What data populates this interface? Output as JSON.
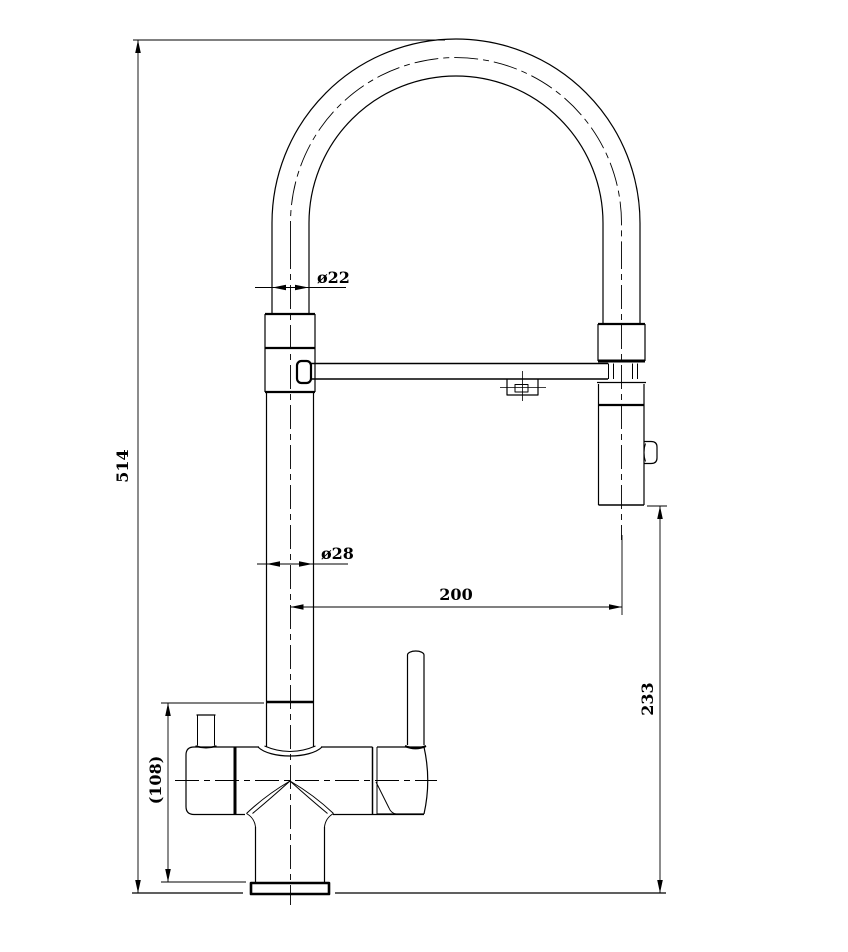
{
  "drawing": {
    "background_color": "#ffffff",
    "line_color": "#000000",
    "labels": {
      "overall_height": "514",
      "hose_diameter": "ø22",
      "riser_diameter": "ø28",
      "spout_reach": "200",
      "head_to_deck_height": "233",
      "body_height": "(108)"
    }
  }
}
